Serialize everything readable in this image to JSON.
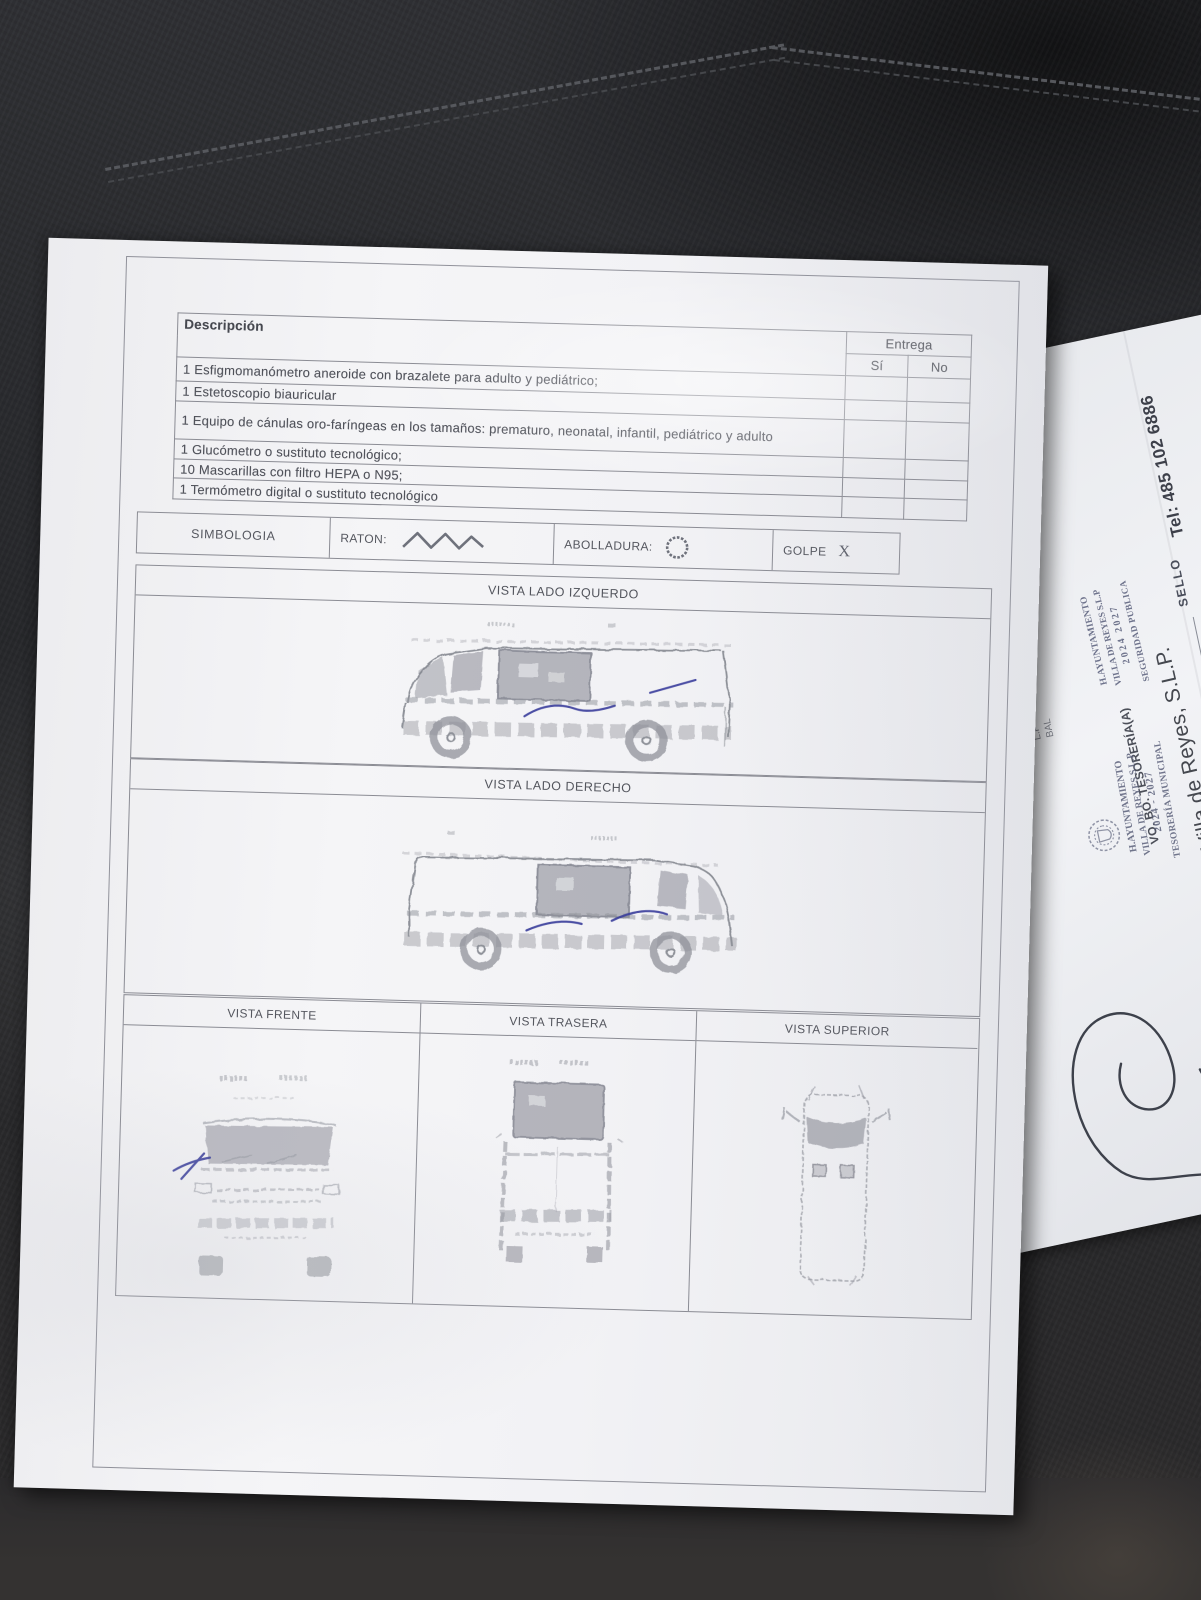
{
  "form": {
    "description_header": "Descripción",
    "entrega": {
      "label": "Entrega",
      "yes": "Sí",
      "no": "No"
    },
    "items": [
      "1 Esfigmomanómetro aneroide con brazalete para adulto y pediátrico;",
      "1 Estetoscopio biauricular",
      "1 Equipo de cánulas oro-faríngeas en los tamaños: prematuro, neonatal, infantil, pediátrico y adulto",
      "1 Glucómetro o sustituto tecnológico;",
      "10 Mascarillas con filtro HEPA o  N95;",
      "1 Termómetro digital o sustituto tecnológico"
    ],
    "simbologia": {
      "title": "SIMBOLOGIA",
      "raton_label": "RATON:",
      "abolladura_label": "ABOLLADURA:",
      "golpe_label": "GOLPE",
      "golpe_symbol": "X"
    },
    "views": {
      "left_label": "VISTA LADO IZQUERDO",
      "right_label": "VISTA LADO DERECHO",
      "front_label": "VISTA FRENTE",
      "rear_label": "VISTA TRASERA",
      "top_label": "VISTA SUPERIOR"
    }
  },
  "under_sheet": {
    "stamp_seguridad": {
      "line1": "H.AYUNTAMIENTO",
      "line2": "VILLA DE REYES S.L.P",
      "line3": "2024  2027",
      "line4": "SEGURIDAD PUBLICA"
    },
    "stamp_tesoreria": {
      "line1": "H.AYUNTAMIENTO",
      "line2": "VILLA DE REYES S.L.P",
      "line3": "2024 - 2027",
      "line4": "TESORERÍA MUNICIPAL"
    },
    "sello_label": "SELLO",
    "tel": "Tel: 485 102 6886",
    "vobo": "VO. BO. TESORERÍA(A)",
    "city": "Villa de Reyes, S.L.P.",
    "fragment1": "L.P",
    "fragment2": "BAL"
  },
  "colors": {
    "pen_blue": "#383c9b",
    "stamp_ink": "#5b607a",
    "copy_gray": "#7a7c88",
    "paper": "#f2f3f5"
  }
}
